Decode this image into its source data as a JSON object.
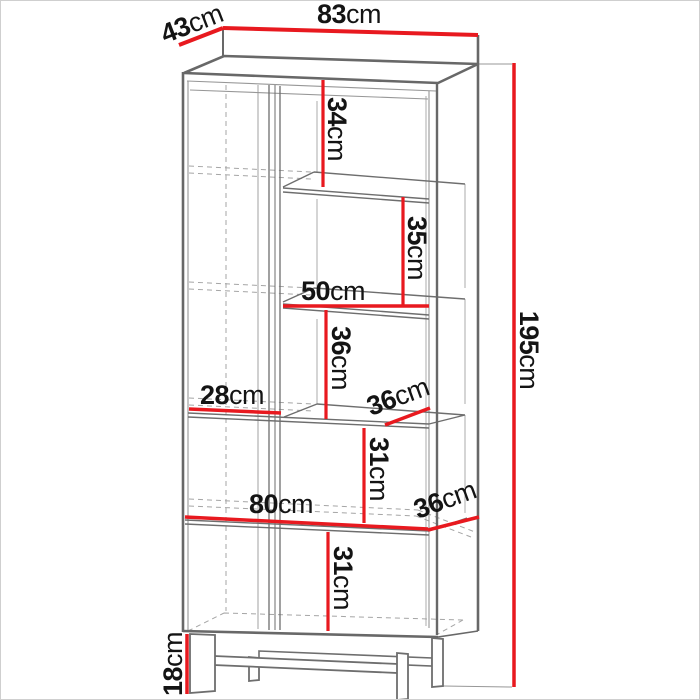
{
  "diagram": {
    "type": "furniture-dimension-drawing",
    "subject": "tall bookcase with left door, open shelves and metal legs",
    "unit": "cm",
    "colors": {
      "dimension_line": "#e8191f",
      "drawing_line": "#6e6e6e",
      "label_text": "#141414",
      "background": "#ffffff"
    },
    "dimensions": [
      {
        "id": "depth-top",
        "value": "43",
        "unit": "cm"
      },
      {
        "id": "width-top",
        "value": "83",
        "unit": "cm"
      },
      {
        "id": "height-overall",
        "value": "195",
        "unit": "cm"
      },
      {
        "id": "top-shelf-height",
        "value": "34",
        "unit": "cm"
      },
      {
        "id": "second-shelf-height",
        "value": "35",
        "unit": "cm"
      },
      {
        "id": "right-shelf-width",
        "value": "50",
        "unit": "cm"
      },
      {
        "id": "third-shelf-height",
        "value": "36",
        "unit": "cm"
      },
      {
        "id": "left-compartment-width",
        "value": "28",
        "unit": "cm"
      },
      {
        "id": "shelf-depth-upper",
        "value": "36",
        "unit": "cm"
      },
      {
        "id": "fourth-shelf-height",
        "value": "31",
        "unit": "cm"
      },
      {
        "id": "interior-width",
        "value": "80",
        "unit": "cm"
      },
      {
        "id": "shelf-depth-lower",
        "value": "36",
        "unit": "cm"
      },
      {
        "id": "bottom-section-height",
        "value": "31",
        "unit": "cm"
      },
      {
        "id": "leg-height",
        "value": "18",
        "unit": "cm"
      }
    ]
  }
}
